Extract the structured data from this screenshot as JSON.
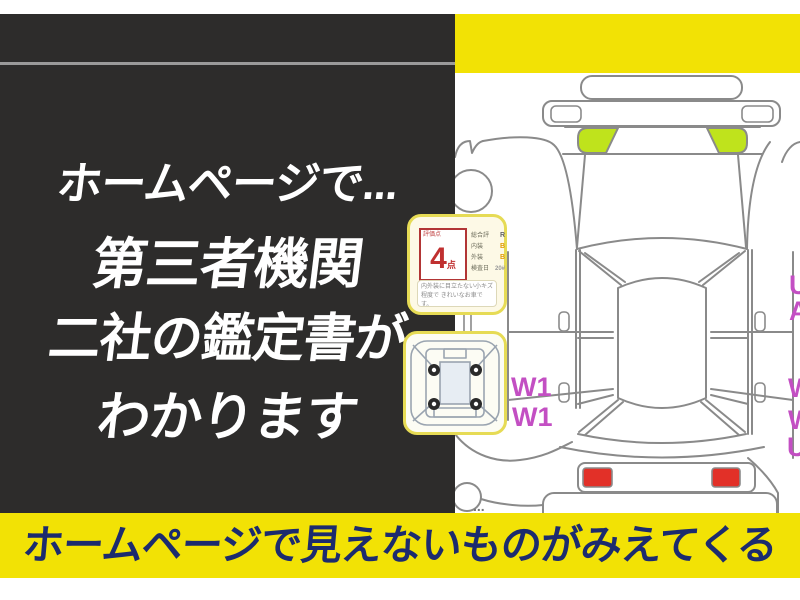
{
  "headline": {
    "line1": "ホームページで...",
    "line2": "第三者機関",
    "line3": "二社の鑑定書が",
    "line4": "わかります"
  },
  "banner": {
    "text": "ホームページで見えないものがみえてくる"
  },
  "rating_card": {
    "score_label": "評価点",
    "score": "4",
    "score_unit": "点",
    "rows": [
      {
        "label": "総合評",
        "value": "R"
      },
      {
        "label": "内装",
        "value": "B"
      },
      {
        "label": "外装",
        "value": "B"
      },
      {
        "label": "検査日",
        "value": "20#"
      }
    ],
    "note_line1": "内外装に目立たない小キズ程度で",
    "note_line2": "きれいなお車です。"
  },
  "inspection_marks": {
    "left": [
      "W1",
      "W1"
    ],
    "right": [
      "U",
      "A",
      "W",
      "W",
      "U"
    ],
    "ellipsis": "..."
  },
  "colors": {
    "panel_black": "#2d2c2b",
    "accent_yellow": "#f2e205",
    "banner_navy": "#1c2b6e",
    "mark_magenta": "#c34fc3",
    "highlight_green": "#bfe31c",
    "taillight_red": "#e23028",
    "rating_red": "#c03030"
  }
}
